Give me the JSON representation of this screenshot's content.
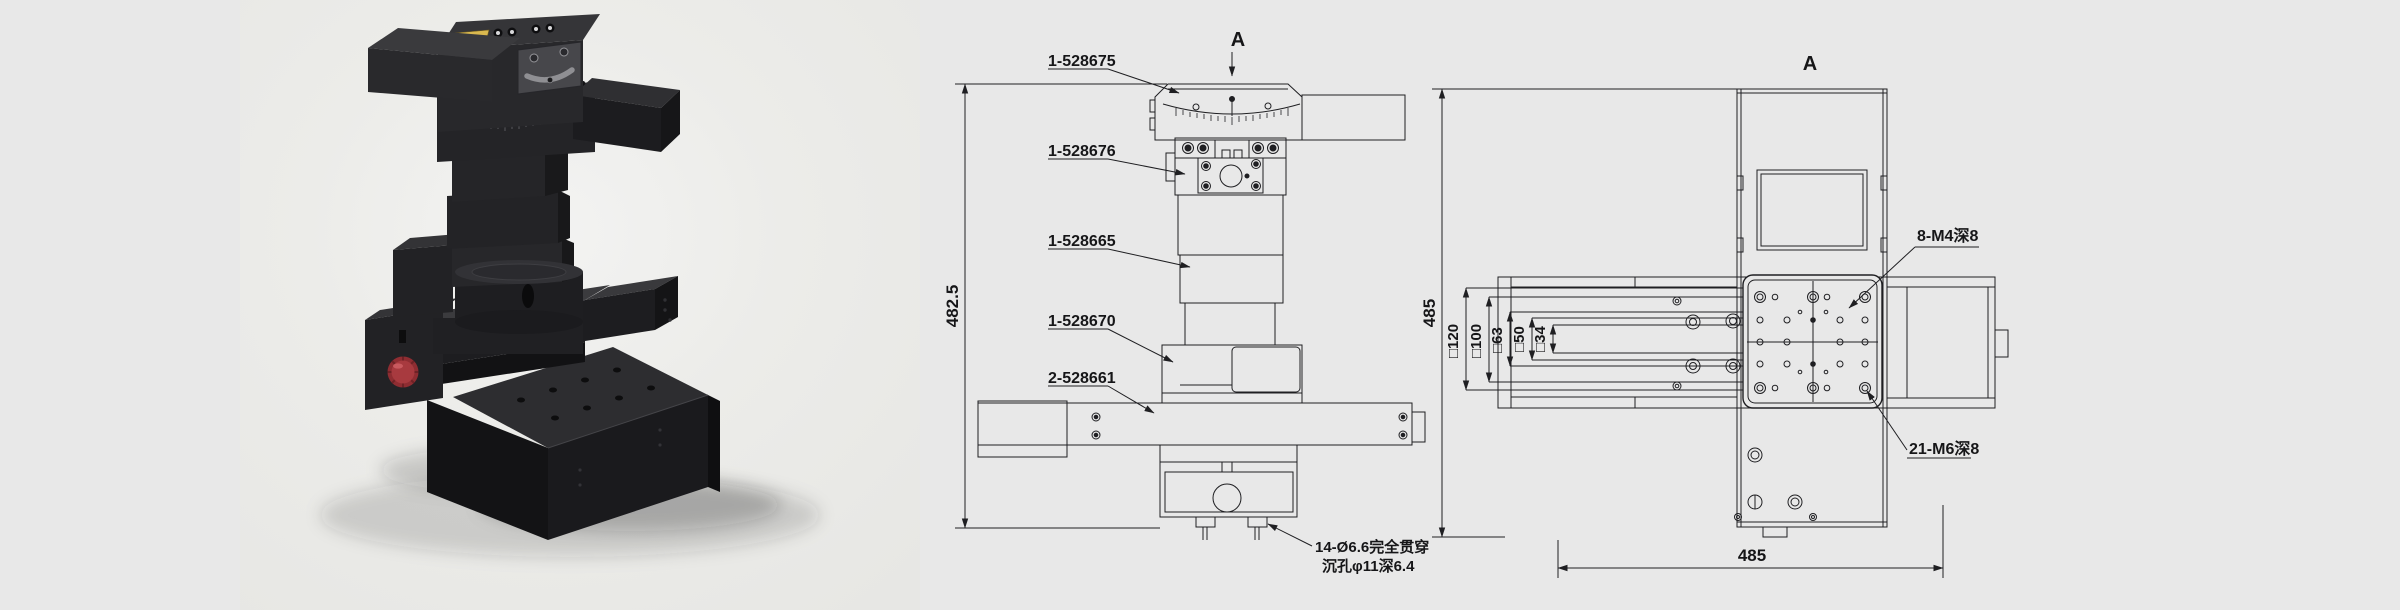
{
  "window": {
    "width": 2400,
    "height": 610,
    "background": "#e8e8e8"
  },
  "product_photo": {
    "description": "black multi-axis motorized positioning stage stack with goniometer top, rotation stage and crossed linear rails",
    "colors": {
      "body": "#1d1d20",
      "top_faces": "#39393c",
      "knob_red": "#a23237",
      "label_gold": "#d9b84f"
    }
  },
  "front_view": {
    "view_arrow_label": "A",
    "overall_height_dim": "482.5",
    "part_labels": [
      "1-528675",
      "1-528676",
      "1-528665",
      "1-528670",
      "2-528661"
    ],
    "hole_note_line1": "14-Ø6.6完全贯穿",
    "hole_note_line2": "沉孔φ11深6.4"
  },
  "top_view": {
    "view_label": "A",
    "height_dim": "485",
    "width_dim": "485",
    "square_dims": [
      "□120",
      "□100",
      "□63",
      "□50",
      "□34"
    ],
    "thread_note_top": "8-M4深8",
    "thread_note_bottom": "21-M6深8"
  }
}
